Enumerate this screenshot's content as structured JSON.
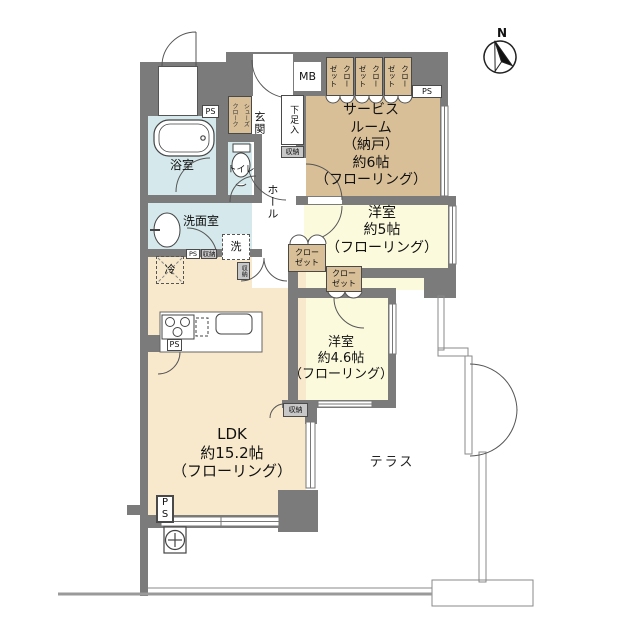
{
  "compass": {
    "north": "N"
  },
  "rooms": {
    "service": "サービス\nルーム\n（納戸）\n約6帖\n（フローリング）",
    "west5": "洋室\n約5帖\n（フローリング）",
    "west46": "洋室\n約4.6帖\n（フローリング）",
    "ldk": "LDK\n約15.2帖\n（フローリング）",
    "terrace": "テラス",
    "bath": "浴室",
    "toilet": "トイレ",
    "washroom": "洗面室",
    "entrance": "玄関",
    "hall": "ホール",
    "shoe_cabinet": "下足入",
    "shoes_closet": "シューズ\nクローク"
  },
  "labels": {
    "mb": "MB",
    "ps": "PS",
    "ps_vertical": "P\nS",
    "storage": "収納",
    "washer": "洗",
    "fridge": "冷",
    "closet_vertical": "クロー\nゼット",
    "closet_block": "クロー\nゼット"
  },
  "colors": {
    "wall": "#7b7b7b",
    "closet_tan": "#d8bf97",
    "ldk_cream": "#f8e9cc",
    "room_yellow": "#fcfadd",
    "water_blue": "#d5e8ec"
  }
}
